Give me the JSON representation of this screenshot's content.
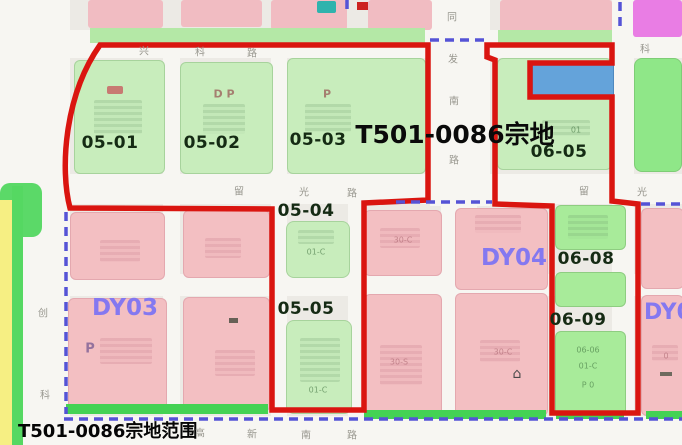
{
  "map": {
    "caption": "T501-0086宗地范围",
    "area_label": "T501-0086宗地",
    "parcels": {
      "p05_01": "05-01",
      "p05_02": "05-02",
      "p05_03": "05-03",
      "p05_04": "05-04",
      "p05_05": "05-05",
      "p06_05": "06-05",
      "p06_08": "06-08",
      "p06_09": "06-09"
    },
    "zones": {
      "dy03": "DY03",
      "dy04": "DY04",
      "dy05": "DY05"
    },
    "roads": {
      "xingke": [
        "兴",
        "科",
        "路"
      ],
      "ke_east": "科",
      "liuguang_west": [
        "留",
        "光",
        "路"
      ],
      "liuguang_east": [
        "留",
        "光"
      ],
      "fanan": [
        "同",
        "发",
        "南",
        "路"
      ],
      "gaoxin_south": [
        "高",
        "新",
        "南",
        "路"
      ],
      "chuangke_west": [
        "创",
        "科"
      ]
    },
    "small_texts": {
      "dp_0502": "D P",
      "p_0503": "P",
      "p_dy03": "P",
      "c30_col1_top": "30-C",
      "s30_col1_bottom": "30-S",
      "c30_col2_bottom": "30-C",
      "arm_0606": "06-06",
      "arm_01c": "01-C",
      "arm_p0": "P 0",
      "s01c_0504": "01-C",
      "s01c_0505": "01-C",
      "s0_col4": "0",
      "s01_0605": "01"
    },
    "icons": {
      "house_glyph": "⌂"
    },
    "legend_colors": {
      "boundary_red": "#da1510",
      "unit_boundary_dashed": "#5553d6",
      "green_parcel": "#c8edbc",
      "pink_parcel": "#f3bfc2",
      "blue_parcel": "#64a3da",
      "magenta_parcel": "#e97de4"
    }
  }
}
